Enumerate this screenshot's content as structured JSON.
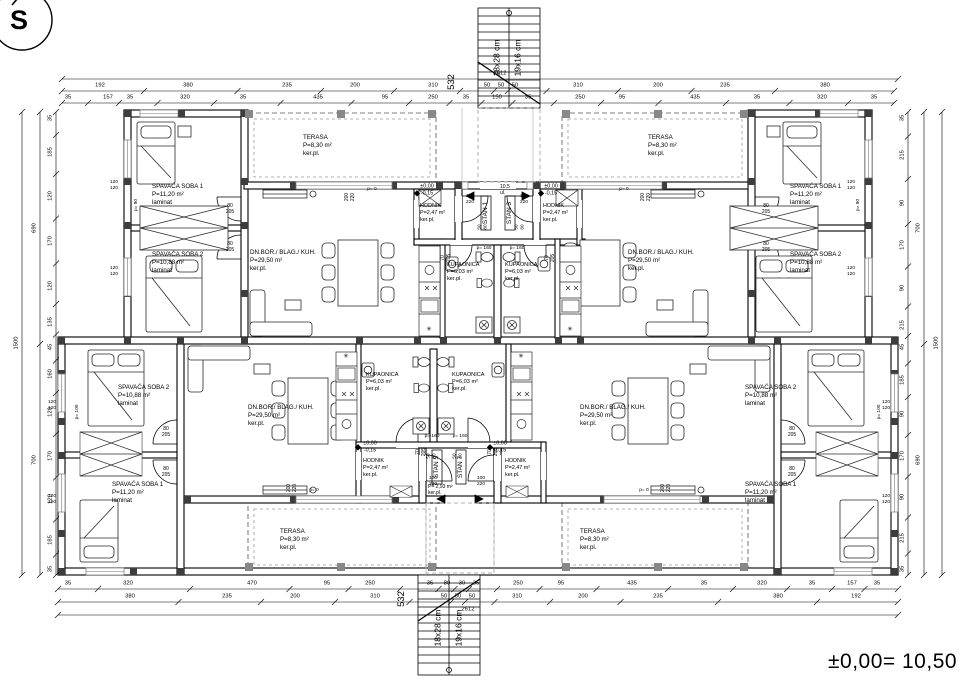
{
  "meta": {
    "north_letter": "S",
    "level_note": "±0,00= 10,50"
  },
  "texts": [
    {
      "n": "stair-top-riser-label",
      "t": "18x28 cm",
      "x": 497,
      "y": 58,
      "r": -90,
      "s": 8.5
    },
    {
      "n": "stair-top-tread-label",
      "t": "19x16 cm",
      "x": 518,
      "y": 58,
      "r": -90,
      "s": 8.5
    },
    {
      "n": "stair-bottom-riser-label",
      "t": "18x28 cm",
      "x": 438,
      "y": 628,
      "r": -90,
      "s": 8.5
    },
    {
      "n": "stair-bottom-tread-label",
      "t": "19x16 cm",
      "x": 459,
      "y": 628,
      "r": -90,
      "s": 8.5
    },
    {
      "n": "dim-532-top",
      "t": "532",
      "x": 452,
      "y": 82,
      "r": -90,
      "s": 9.5
    },
    {
      "n": "dim-532-bottom",
      "t": "532",
      "x": 402,
      "y": 599,
      "r": -90,
      "s": 9.5
    },
    {
      "n": "room-tl-soba1",
      "t": "SPAVAĆA SOBA 1\nP=11,20 m²\nlaminat",
      "x": 152,
      "y": 183,
      "al": "l"
    },
    {
      "n": "room-tl-soba2",
      "t": "SPAVAĆA SOBA 2\nP=10,88 m²\nlaminat",
      "x": 152,
      "y": 251,
      "al": "l"
    },
    {
      "n": "room-tl-terasa",
      "t": "TERASA\nP=8,30 m²\nker.pl.",
      "x": 303,
      "y": 134,
      "al": "l"
    },
    {
      "n": "room-tl-living",
      "t": "DN.BOR./ BLAG./ KUH.\nP=29,50 m²\nker.pl.",
      "x": 250,
      "y": 249,
      "al": "l"
    },
    {
      "n": "room-tl-kupaonica",
      "t": "KUPAONICA\nP=6,03 m²\nker.pl.",
      "x": 447,
      "y": 262,
      "al": "l",
      "s": 5.6
    },
    {
      "n": "room-tl-hodnik",
      "t": "HODNIK\nP=2,47 m²\nker.pl.",
      "x": 420,
      "y": 203,
      "al": "l",
      "s": 5.4
    },
    {
      "n": "level-mark-tl",
      "t": "±0,00\n-0,15",
      "x": 427,
      "y": 190,
      "s": 5.4
    },
    {
      "n": "room-tr-soba1",
      "t": "SPAVAĆA SOBA 1\nP=11,20 m²\nlaminat",
      "x": 790,
      "y": 183,
      "al": "l"
    },
    {
      "n": "room-tr-soba2",
      "t": "SPAVAĆA SOBA 2\nP=10,88 m²\nlaminat",
      "x": 790,
      "y": 251,
      "al": "l"
    },
    {
      "n": "room-tr-terasa",
      "t": "TERASA\nP=8,30 m²\nker.pl.",
      "x": 648,
      "y": 134,
      "al": "l"
    },
    {
      "n": "room-tr-living",
      "t": "DN.BOR./ BLAG./ KUH.\nP=29,50 m²\nker.pl.",
      "x": 628,
      "y": 249,
      "al": "l"
    },
    {
      "n": "room-tr-kupaonica",
      "t": "KUPAONICA\nP=6,03 m²\nker.pl.",
      "x": 505,
      "y": 262,
      "al": "l",
      "s": 5.6
    },
    {
      "n": "room-tr-hodnik",
      "t": "HODNIK\nP=2,47 m²\nker.pl.",
      "x": 543,
      "y": 203,
      "al": "l",
      "s": 5.4
    },
    {
      "n": "level-mark-tr",
      "t": "±0,00\n-0,15",
      "x": 551,
      "y": 190,
      "s": 5.4
    },
    {
      "n": "room-bl-soba2",
      "t": "SPAVAĆA SOBA 2\nP=10,88 m²\nlaminat",
      "x": 118,
      "y": 384,
      "al": "l"
    },
    {
      "n": "room-bl-soba1",
      "t": "SPAVAĆA SOBA 1\nP=11,20 m²\nlaminat",
      "x": 112,
      "y": 481,
      "al": "l"
    },
    {
      "n": "room-bl-living",
      "t": "DN.BOR./ BLAG./ KUH.\nP=29,50 m²\nker.pl.",
      "x": 248,
      "y": 404,
      "al": "l"
    },
    {
      "n": "room-bl-kupaonica",
      "t": "KUPAONICA\nP=6,03 m²\nker.pl.",
      "x": 366,
      "y": 372,
      "al": "l",
      "s": 5.6
    },
    {
      "n": "room-bl-hodnik",
      "t": "HODNIK\nP=2,47 m²\nker.pl.",
      "x": 363,
      "y": 458,
      "al": "l",
      "s": 5.4
    },
    {
      "n": "level-mark-bl",
      "t": "±0,00\n-0,15",
      "x": 370,
      "y": 447,
      "s": 5.4
    },
    {
      "n": "room-br-soba2",
      "t": "SPAVAĆA SOBA 2\nP=10,88 m²\nlaminat",
      "x": 745,
      "y": 384,
      "al": "l"
    },
    {
      "n": "room-br-soba1",
      "t": "SPAVAĆA SOBA 1\nP=11,20 m²\nlaminat",
      "x": 745,
      "y": 481,
      "al": "l"
    },
    {
      "n": "room-br-living",
      "t": "DN.BOR./ BLAG./ KUH.\nP=29,50 m²\nker.pl.",
      "x": 580,
      "y": 404,
      "al": "l"
    },
    {
      "n": "room-br-kupaonica",
      "t": "KUPAONICA\nP=6,03 m²\nker.pl.",
      "x": 452,
      "y": 372,
      "al": "l",
      "s": 5.6
    },
    {
      "n": "room-br-hodnik",
      "t": "HODNIK\nP=2,47 m²\nker.pl.",
      "x": 505,
      "y": 458,
      "al": "l",
      "s": 5.4
    },
    {
      "n": "level-mark-br",
      "t": "±0,00\n-0,15",
      "x": 500,
      "y": 447,
      "s": 5.4
    },
    {
      "n": "room-bl-terasa",
      "t": "TERASA\nP=8,30 m²\nker.pl.",
      "x": 280,
      "y": 528,
      "al": "l"
    },
    {
      "n": "room-br-terasa",
      "t": "TERASA\nP=8,30 m²\nker.pl.",
      "x": 580,
      "y": 528,
      "al": "l"
    },
    {
      "n": "plate-stan-1",
      "t": "STAN 1",
      "x": 486,
      "y": 213,
      "r": -90,
      "s": 6.5
    },
    {
      "n": "plate-stan-3",
      "t": "STAN 3",
      "x": 510,
      "y": 213,
      "r": -90,
      "s": 6.5
    },
    {
      "n": "plate-stan-5",
      "t": "STAN 5",
      "x": 437,
      "y": 467,
      "r": -90,
      "s": 6.5
    },
    {
      "n": "plate-stan-7",
      "t": "STAN 7",
      "x": 461,
      "y": 467,
      "r": -90,
      "s": 6.5
    },
    {
      "n": "vestibule-top-note",
      "t": "10,5\nul.",
      "x": 500,
      "y": 184,
      "al": "l",
      "s": 5
    },
    {
      "n": "vestibule-bottom-note",
      "t": "P= 2,93 m²\nker.pl.",
      "x": 428,
      "y": 484,
      "al": "l",
      "s": 5
    },
    {
      "n": "door-label-tl-soba1",
      "t": "80\n205",
      "x": 230,
      "y": 209,
      "s": 5
    },
    {
      "n": "door-label-tl-soba2",
      "t": "80\n205",
      "x": 230,
      "y": 247,
      "s": 5
    },
    {
      "n": "door-label-tr-soba1",
      "t": "80\n205",
      "x": 766,
      "y": 209,
      "s": 5
    },
    {
      "n": "door-label-tr-soba2",
      "t": "80\n205",
      "x": 766,
      "y": 247,
      "s": 5
    },
    {
      "n": "door-label-bl-soba2",
      "t": "80\n205",
      "x": 166,
      "y": 432,
      "s": 5
    },
    {
      "n": "door-label-bl-soba1",
      "t": "80\n205",
      "x": 166,
      "y": 472,
      "s": 5
    },
    {
      "n": "door-label-br-soba2",
      "t": "80\n205",
      "x": 792,
      "y": 432,
      "s": 5
    },
    {
      "n": "door-label-br-soba1",
      "t": "80\n205",
      "x": 792,
      "y": 472,
      "s": 5
    },
    {
      "n": "door-label-bath-tl",
      "t": "70\n205",
      "x": 446,
      "y": 258,
      "r": -90,
      "s": 5
    },
    {
      "n": "door-label-bath-tr",
      "t": "70\n205",
      "x": 550,
      "y": 258,
      "r": -90,
      "s": 5
    },
    {
      "n": "door-label-bath-bl",
      "t": "70\n205",
      "x": 421,
      "y": 452,
      "r": -90,
      "s": 5
    },
    {
      "n": "door-label-bath-br",
      "t": "70\n205",
      "x": 493,
      "y": 452,
      "r": -90,
      "s": 5
    },
    {
      "n": "door-label-entry-tl",
      "t": "100\n220",
      "x": 470,
      "y": 200,
      "s": 4.8
    },
    {
      "n": "door-label-entry-tr",
      "t": "100\n220",
      "x": 524,
      "y": 200,
      "s": 4.8
    },
    {
      "n": "door-label-entry-bl",
      "t": "100\n220",
      "x": 433,
      "y": 482,
      "s": 4.8
    },
    {
      "n": "door-label-entry-br",
      "t": "100\n220",
      "x": 481,
      "y": 482,
      "s": 4.8
    },
    {
      "n": "window-label-vest-tl",
      "t": "50\n80",
      "x": 482,
      "y": 227,
      "r": -90,
      "s": 4.6
    },
    {
      "n": "window-label-vest-tr",
      "t": "50\n80",
      "x": 519,
      "y": 227,
      "r": -90,
      "s": 4.6
    },
    {
      "n": "window-label-vest-bl",
      "t": "50\n80",
      "x": 431,
      "y": 456,
      "r": -90,
      "s": 4.6
    },
    {
      "n": "window-label-vest-br",
      "t": "50\n80",
      "x": 457,
      "y": 456,
      "r": -90,
      "s": 4.6
    },
    {
      "n": "sill-label-vest-tl",
      "t": "p= 160",
      "x": 484,
      "y": 249,
      "s": 4.8
    },
    {
      "n": "sill-label-vest-tr",
      "t": "p= 160",
      "x": 517,
      "y": 249,
      "s": 4.8
    },
    {
      "n": "sill-label-vest-bl",
      "t": "p= 160",
      "x": 432,
      "y": 437,
      "s": 4.8
    },
    {
      "n": "sill-label-vest-br",
      "t": "p= 160",
      "x": 460,
      "y": 437,
      "s": 4.8
    },
    {
      "n": "window-label-terr-tl",
      "t": "200\n220",
      "x": 350,
      "y": 197,
      "r": -90,
      "s": 5
    },
    {
      "n": "window-label-terr-tr",
      "t": "200\n220",
      "x": 646,
      "y": 197,
      "r": -90,
      "s": 5
    },
    {
      "n": "window-label-terr-bl",
      "t": "200\n220",
      "x": 292,
      "y": 488,
      "r": -90,
      "s": 5
    },
    {
      "n": "window-label-terr-br",
      "t": "200\n220",
      "x": 666,
      "y": 488,
      "r": -90,
      "s": 5
    },
    {
      "n": "sill-label-terr-tl",
      "t": "p= 0",
      "x": 372,
      "y": 190,
      "s": 4.8
    },
    {
      "n": "sill-label-terr-tr",
      "t": "p= 0",
      "x": 624,
      "y": 190,
      "s": 4.8
    },
    {
      "n": "sill-label-terr-bl",
      "t": "p= 0",
      "x": 314,
      "y": 491,
      "s": 4.8
    },
    {
      "n": "sill-label-terr-br",
      "t": "p= 0",
      "x": 644,
      "y": 491,
      "s": 4.8
    },
    {
      "n": "window-label-tl-1",
      "t": "120\n120",
      "x": 114,
      "y": 186,
      "s": 4.8
    },
    {
      "n": "window-label-tr-1",
      "t": "120\n120",
      "x": 851,
      "y": 186,
      "s": 4.8
    },
    {
      "n": "window-label-tl-2",
      "t": "120\n120",
      "x": 114,
      "y": 272,
      "s": 4.8
    },
    {
      "n": "window-label-tr-2",
      "t": "120\n120",
      "x": 851,
      "y": 272,
      "s": 4.8
    },
    {
      "n": "window-label-bl-1",
      "t": "120\n120",
      "x": 52,
      "y": 406,
      "s": 4.8
    },
    {
      "n": "window-label-bl-2",
      "t": "120\n120",
      "x": 52,
      "y": 500,
      "s": 4.8
    },
    {
      "n": "window-label-br-1",
      "t": "120\n120",
      "x": 886,
      "y": 406,
      "s": 4.8
    },
    {
      "n": "window-label-br-2",
      "t": "120\n120",
      "x": 886,
      "y": 500,
      "s": 4.8
    },
    {
      "n": "sill-label-tl",
      "t": "p= 90",
      "x": 137,
      "y": 205,
      "r": -90,
      "s": 4.8
    },
    {
      "n": "sill-label-tr",
      "t": "p= 90",
      "x": 859,
      "y": 205,
      "r": -90,
      "s": 4.8
    },
    {
      "n": "sill-label-bl",
      "t": "p= 100",
      "x": 78,
      "y": 412,
      "r": -90,
      "s": 4.8
    },
    {
      "n": "sill-label-br",
      "t": "p= 100",
      "x": 880,
      "y": 412,
      "r": -90,
      "s": 4.8
    },
    {
      "n": "boiler-symbol-tl",
      "t": "✳",
      "x": 429,
      "y": 330,
      "s": 6.5
    },
    {
      "n": "boiler-symbol-tr",
      "t": "✳",
      "x": 570,
      "y": 330,
      "s": 6.5
    },
    {
      "n": "boiler-symbol-bl",
      "t": "✳",
      "x": 346,
      "y": 357,
      "s": 6.5
    },
    {
      "n": "boiler-symbol-br",
      "t": "✳",
      "x": 521,
      "y": 357,
      "s": 6.5
    }
  ],
  "dim_rows": [
    {
      "n": "dim-top-overall",
      "axis": "h",
      "y": 79,
      "x1": 62,
      "x2": 898,
      "items": [
        {
          "x": 500,
          "t": "2612"
        }
      ]
    },
    {
      "n": "dim-top-major",
      "axis": "h",
      "y": 91,
      "x1": 62,
      "x2": 894,
      "items": [
        {
          "x": 100,
          "t": "192"
        },
        {
          "x": 188,
          "t": "380"
        },
        {
          "x": 287,
          "t": "235"
        },
        {
          "x": 355,
          "t": "200"
        },
        {
          "x": 433,
          "t": "310"
        },
        {
          "x": 487,
          "t": "50"
        },
        {
          "x": 501,
          "t": "50"
        },
        {
          "x": 515,
          "t": "50"
        },
        {
          "x": 578,
          "t": "310"
        },
        {
          "x": 658,
          "t": "200"
        },
        {
          "x": 725,
          "t": "235"
        },
        {
          "x": 825,
          "t": "380"
        }
      ]
    },
    {
      "n": "dim-top-minor",
      "axis": "h",
      "y": 103,
      "x1": 62,
      "x2": 894,
      "items": [
        {
          "x": 68,
          "t": "35"
        },
        {
          "x": 108,
          "t": "157"
        },
        {
          "x": 130,
          "t": "35"
        },
        {
          "x": 185,
          "t": "320"
        },
        {
          "x": 243,
          "t": "35"
        },
        {
          "x": 318,
          "t": "435"
        },
        {
          "x": 385,
          "t": "95"
        },
        {
          "x": 433,
          "t": "250"
        },
        {
          "x": 466,
          "t": "35"
        },
        {
          "x": 497,
          "t": "150"
        },
        {
          "x": 528,
          "t": "35"
        },
        {
          "x": 580,
          "t": "250"
        },
        {
          "x": 622,
          "t": "95"
        },
        {
          "x": 695,
          "t": "435"
        },
        {
          "x": 757,
          "t": "35"
        },
        {
          "x": 822,
          "t": "320"
        },
        {
          "x": 874,
          "t": "35"
        }
      ]
    },
    {
      "n": "dim-bottom-minor",
      "axis": "h",
      "y": 589,
      "x1": 58,
      "x2": 898,
      "items": [
        {
          "x": 68,
          "t": "35"
        },
        {
          "x": 128,
          "t": "320"
        },
        {
          "x": 252,
          "t": "470"
        },
        {
          "x": 327,
          "t": "95"
        },
        {
          "x": 370,
          "t": "250"
        },
        {
          "x": 430,
          "t": "35"
        },
        {
          "x": 447,
          "t": "80"
        },
        {
          "x": 462,
          "t": "30"
        },
        {
          "x": 476,
          "t": "35"
        },
        {
          "x": 518,
          "t": "250"
        },
        {
          "x": 561,
          "t": "95"
        },
        {
          "x": 632,
          "t": "435"
        },
        {
          "x": 704,
          "t": "35"
        },
        {
          "x": 762,
          "t": "320"
        },
        {
          "x": 812,
          "t": "35"
        },
        {
          "x": 852,
          "t": "157"
        },
        {
          "x": 877,
          "t": "35"
        }
      ]
    },
    {
      "n": "dim-bottom-major",
      "axis": "h",
      "y": 602,
      "x1": 58,
      "x2": 898,
      "items": [
        {
          "x": 130,
          "t": "380"
        },
        {
          "x": 227,
          "t": "235"
        },
        {
          "x": 295,
          "t": "200"
        },
        {
          "x": 375,
          "t": "310"
        },
        {
          "x": 444,
          "t": "50"
        },
        {
          "x": 458,
          "t": "50"
        },
        {
          "x": 472,
          "t": "50"
        },
        {
          "x": 517,
          "t": "310"
        },
        {
          "x": 583,
          "t": "200"
        },
        {
          "x": 658,
          "t": "235"
        },
        {
          "x": 778,
          "t": "380"
        },
        {
          "x": 856,
          "t": "192"
        }
      ]
    },
    {
      "n": "dim-bottom-overall",
      "axis": "h",
      "y": 615,
      "x1": 58,
      "x2": 898,
      "items": [
        {
          "x": 468,
          "t": "2612"
        }
      ]
    },
    {
      "n": "dim-left-minor",
      "axis": "v",
      "x": 56,
      "y1": 112,
      "y2": 575,
      "items": [
        {
          "y": 118,
          "t": "35"
        },
        {
          "y": 152,
          "t": "185"
        },
        {
          "y": 196,
          "t": "120"
        },
        {
          "y": 241,
          "t": "170"
        },
        {
          "y": 286,
          "t": "120"
        },
        {
          "y": 322,
          "t": "135"
        },
        {
          "y": 347,
          "t": "45"
        },
        {
          "y": 374,
          "t": "160"
        },
        {
          "y": 412,
          "t": "120"
        },
        {
          "y": 456,
          "t": "170"
        },
        {
          "y": 499,
          "t": "120"
        },
        {
          "y": 540,
          "t": "185"
        },
        {
          "y": 569,
          "t": "35"
        }
      ]
    },
    {
      "n": "dim-left-major",
      "axis": "v",
      "x": 40,
      "y1": 112,
      "y2": 575,
      "items": [
        {
          "y": 228,
          "t": "690"
        },
        {
          "y": 460,
          "t": "700"
        }
      ]
    },
    {
      "n": "dim-left-overall",
      "axis": "v",
      "x": 22,
      "y1": 112,
      "y2": 575,
      "items": [
        {
          "y": 343,
          "t": "1500"
        }
      ]
    },
    {
      "n": "dim-right-minor",
      "axis": "v",
      "x": 908,
      "y1": 112,
      "y2": 575,
      "items": [
        {
          "y": 118,
          "t": "35"
        },
        {
          "y": 155,
          "t": "215"
        },
        {
          "y": 203,
          "t": "90"
        },
        {
          "y": 245,
          "t": "170"
        },
        {
          "y": 288,
          "t": "90"
        },
        {
          "y": 325,
          "t": "215"
        },
        {
          "y": 347,
          "t": "45"
        },
        {
          "y": 380,
          "t": "185"
        },
        {
          "y": 414,
          "t": "90"
        },
        {
          "y": 456,
          "t": "170"
        },
        {
          "y": 497,
          "t": "90"
        },
        {
          "y": 538,
          "t": "215"
        },
        {
          "y": 569,
          "t": "35"
        }
      ]
    },
    {
      "n": "dim-right-major",
      "axis": "v",
      "x": 924,
      "y1": 112,
      "y2": 575,
      "items": [
        {
          "y": 228,
          "t": "700"
        },
        {
          "y": 460,
          "t": "690"
        }
      ]
    },
    {
      "n": "dim-right-overall",
      "axis": "v",
      "x": 942,
      "y1": 112,
      "y2": 575,
      "items": [
        {
          "y": 343,
          "t": "1500"
        }
      ]
    }
  ]
}
